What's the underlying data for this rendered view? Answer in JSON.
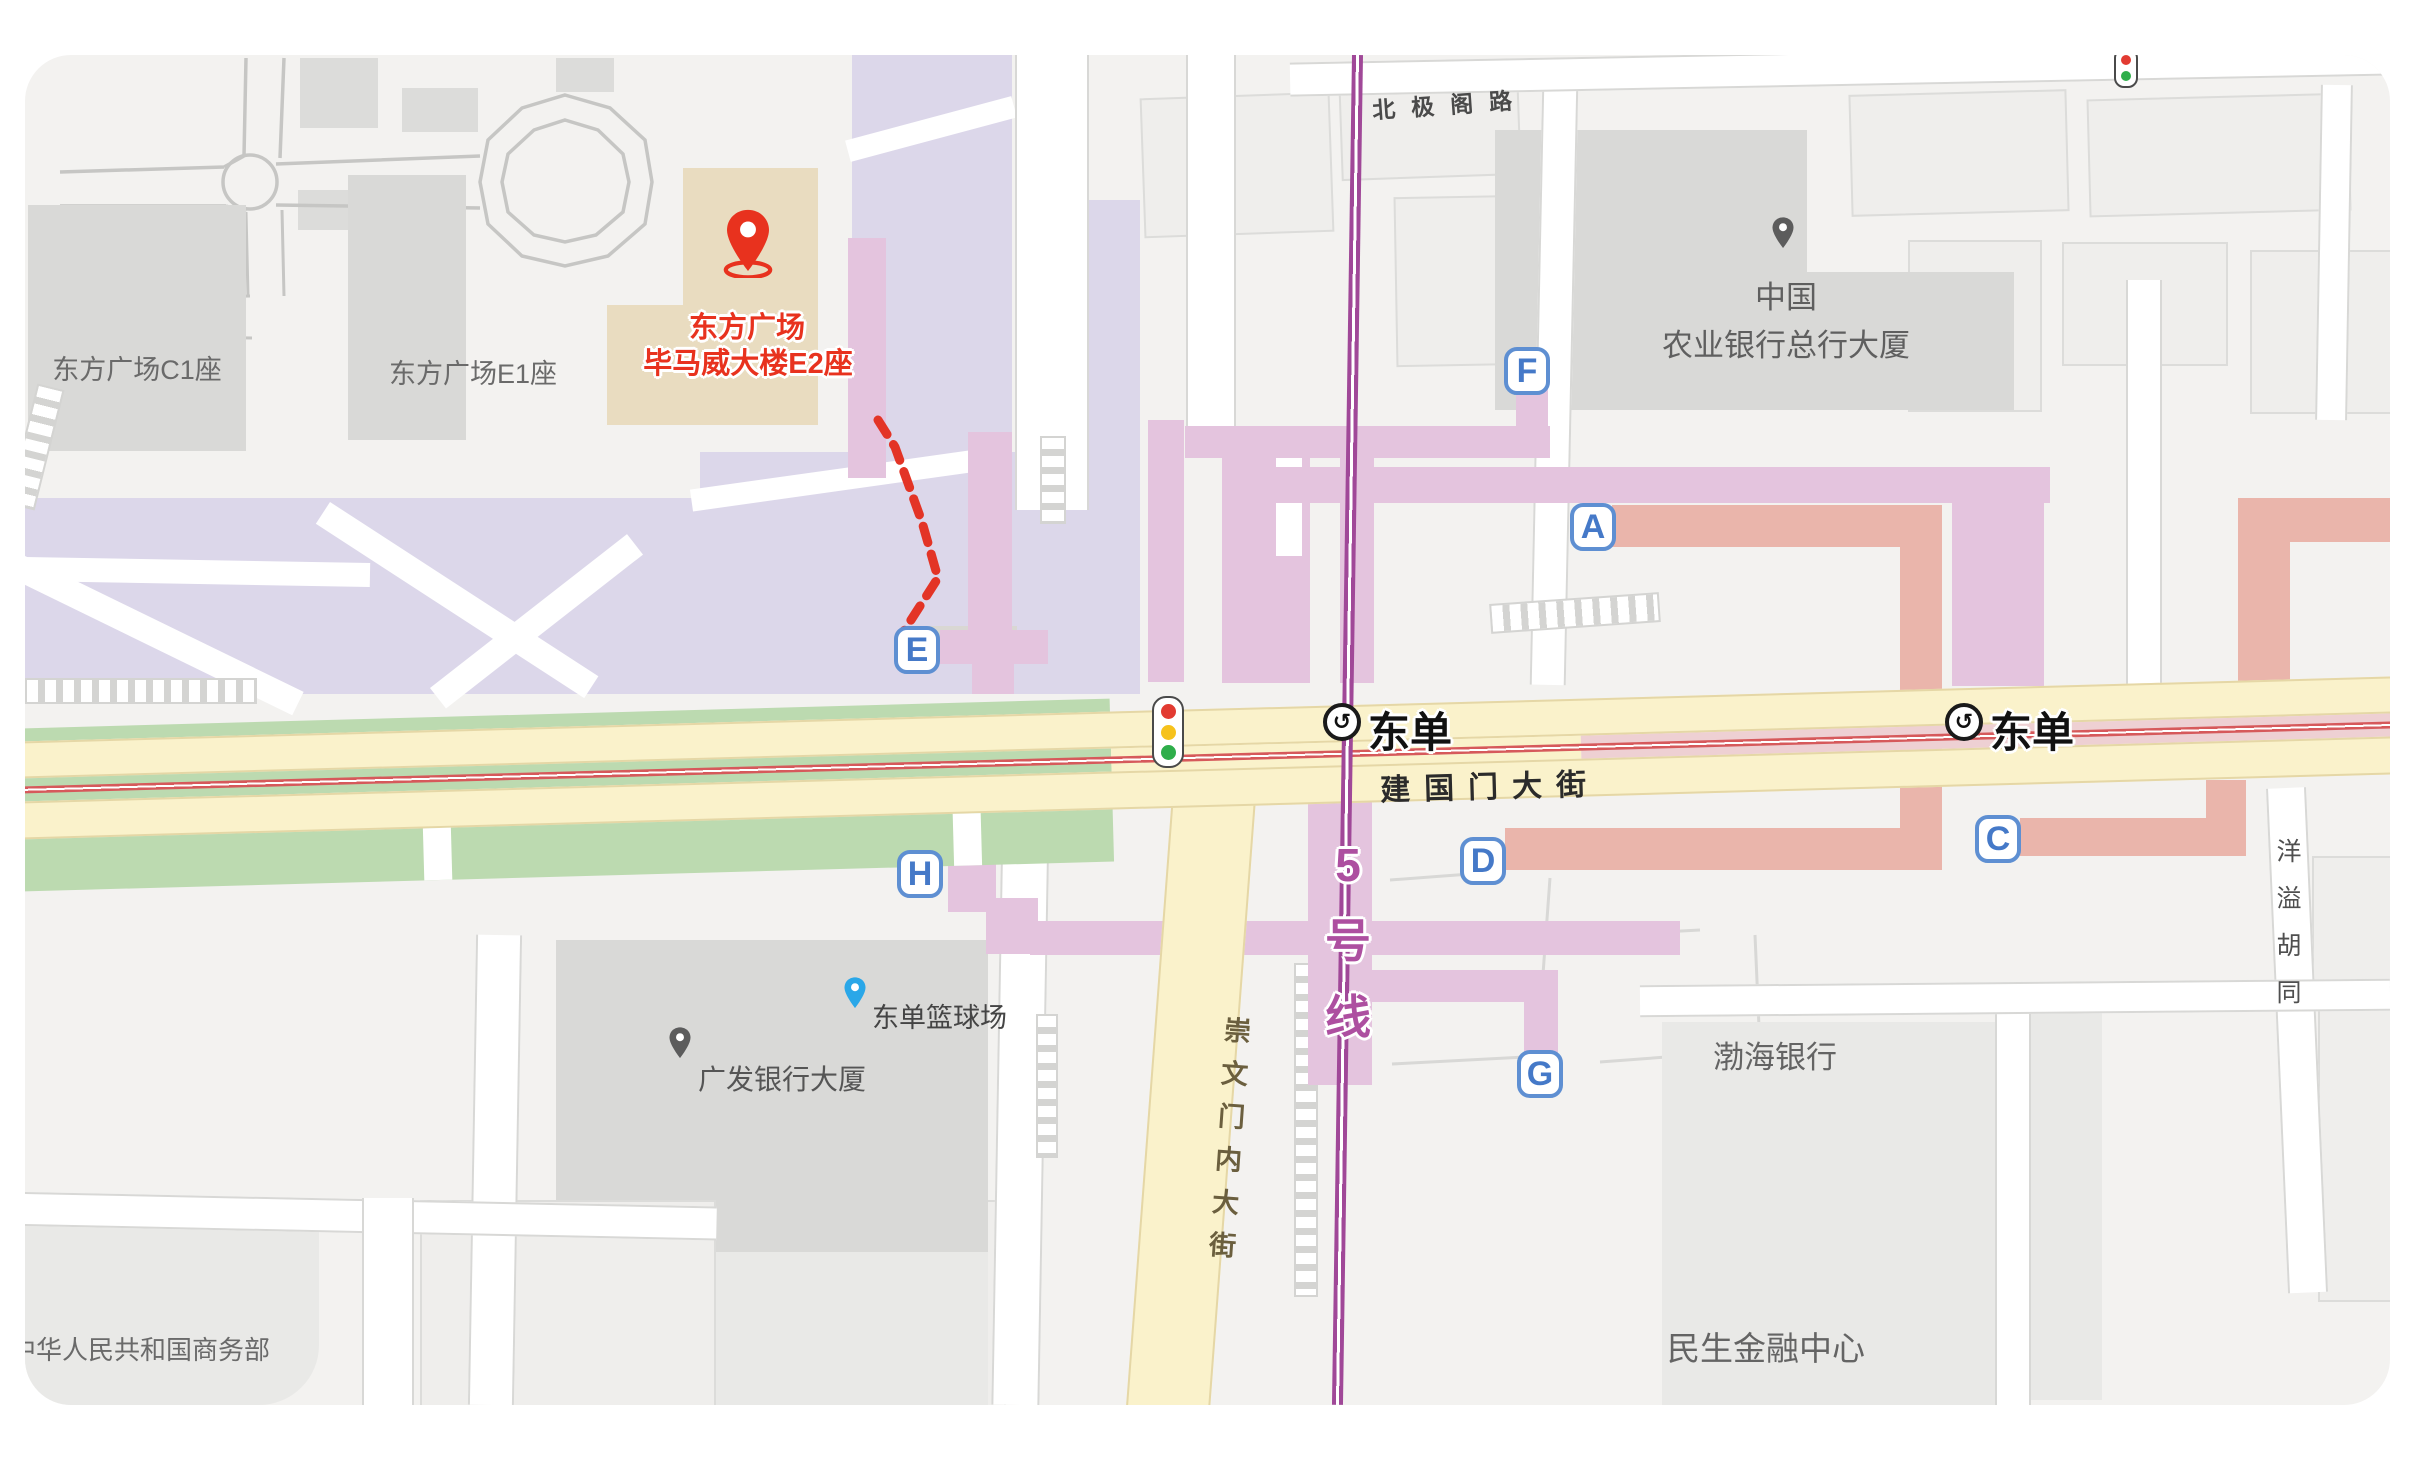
{
  "pin": {
    "line1": "东方广场",
    "line2": "毕马威大楼E2座"
  },
  "places": {
    "dongfang_c1": "东方广场C1座",
    "dongfang_e1": "东方广场E1座",
    "abc_line1": "中国",
    "abc_line2": "农业银行总行大厦",
    "bohai": "渤海银行",
    "minsheng": "民生金融中心",
    "guangfa": "广发银行大厦",
    "basketball": "东单篮球场",
    "mofcom": "中华人民共和国商务部"
  },
  "roads": {
    "beijige": "北极阁路",
    "jianguomen": "建国门大街",
    "chongwen": "崇文门内大街",
    "yangyi": "洋溢胡同"
  },
  "metro": {
    "station_west": "东单",
    "station_east": "东单",
    "line5": "5号线"
  },
  "exits": [
    {
      "label": "A"
    },
    {
      "label": "C"
    },
    {
      "label": "D"
    },
    {
      "label": "E"
    },
    {
      "label": "F"
    },
    {
      "label": "G"
    },
    {
      "label": "H"
    }
  ],
  "colors": {
    "route_red": "#e33426",
    "pin_red": "#e8321e",
    "pin_blue": "#2aa7e8",
    "exit_blue": "#4579c8",
    "line5_magenta": "#a04898",
    "road_yellow": "#faf2cb",
    "passage_pink": "#e4c4de",
    "passage_salmon": "#eab5ab",
    "plaza_lavender": "#dcd7ea",
    "median_green": "#bcdab0",
    "rail_red": "#d6595b"
  }
}
